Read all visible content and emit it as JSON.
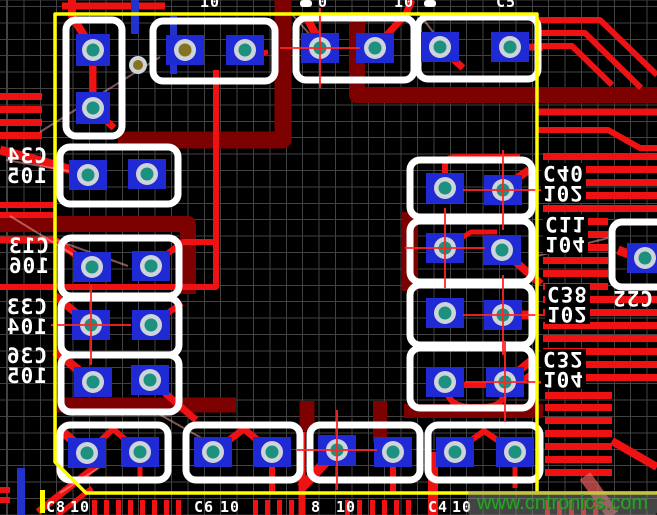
{
  "meta": {
    "width": 657,
    "height": 515,
    "description": "PCB layout close-up with decoupling capacitors around an IC courtyard"
  },
  "watermark": {
    "text": "www.cntronics.com",
    "color": "#2f9e2f",
    "bg": "rgba(135,135,135,0.5)",
    "x": 468,
    "y": 491,
    "w": 189,
    "h": 24
  },
  "labels": {
    "left": [
      {
        "ref": "C34",
        "val": "105",
        "x": 6,
        "y": 146
      },
      {
        "ref": "C13",
        "val": "106",
        "x": 8,
        "y": 236
      },
      {
        "ref": "C33",
        "val": "104",
        "x": 6,
        "y": 297
      },
      {
        "ref": "C36",
        "val": "105",
        "x": 6,
        "y": 346
      }
    ],
    "right": [
      {
        "ref": "C40",
        "val": "102",
        "x": 541,
        "y": 163
      },
      {
        "ref": "C11",
        "val": "104",
        "x": 543,
        "y": 214
      },
      {
        "ref": "C38",
        "val": "102",
        "x": 545,
        "y": 284
      },
      {
        "ref": "C32",
        "val": "104",
        "x": 541,
        "y": 349
      }
    ],
    "outside_right": {
      "text": "C22",
      "x": 612,
      "y": 288
    },
    "top_fragments": [
      {
        "t": "10",
        "x": 200
      },
      {
        "t": "0",
        "x": 318
      },
      {
        "t": "10",
        "x": 394
      },
      {
        "t": "C5",
        "x": 496
      }
    ],
    "bottom_fragments": [
      {
        "t": "C8",
        "x": 46
      },
      {
        "t": "10",
        "x": 70
      },
      {
        "t": "C6",
        "x": 194
      },
      {
        "t": "10",
        "x": 220
      },
      {
        "t": "8",
        "x": 311
      },
      {
        "t": "10",
        "x": 336
      },
      {
        "t": "C4",
        "x": 428
      },
      {
        "t": "10",
        "x": 452
      }
    ]
  },
  "colors": {
    "bg": "#000000",
    "grid": "#424242",
    "yellow": "#ffff00",
    "maroon": "#7d0101",
    "red": "#ee1212",
    "redsoft": "rgba(255,100,100,0.65)",
    "white": "#ffffff",
    "padblue": "#1f2ad4",
    "ring": "#cfd3da",
    "teal": "#1d9180",
    "olive": "#857321",
    "blue": "#2233cc",
    "rats": "rgba(255,170,170,0.5)",
    "cross": "#ff2626"
  },
  "pcb": {
    "pads": [
      {
        "x": 93,
        "y": 50,
        "w": 34,
        "h": 32
      },
      {
        "x": 93,
        "y": 108,
        "w": 34,
        "h": 32
      },
      {
        "x": 185,
        "y": 50,
        "v": "olive"
      },
      {
        "x": 245,
        "y": 50
      },
      {
        "x": 320,
        "y": 48
      },
      {
        "x": 375,
        "y": 48
      },
      {
        "x": 440,
        "y": 47
      },
      {
        "x": 510,
        "y": 47
      },
      {
        "x": 88,
        "y": 175
      },
      {
        "x": 147,
        "y": 174
      },
      {
        "x": 92,
        "y": 267
      },
      {
        "x": 151,
        "y": 266
      },
      {
        "x": 91,
        "y": 325
      },
      {
        "x": 151,
        "y": 325
      },
      {
        "x": 93,
        "y": 382
      },
      {
        "x": 150,
        "y": 380
      },
      {
        "x": 445,
        "y": 188
      },
      {
        "x": 503,
        "y": 190
      },
      {
        "x": 445,
        "y": 248
      },
      {
        "x": 502,
        "y": 250
      },
      {
        "x": 445,
        "y": 313
      },
      {
        "x": 503,
        "y": 315
      },
      {
        "x": 445,
        "y": 382
      },
      {
        "x": 505,
        "y": 382
      },
      {
        "x": 87,
        "y": 453
      },
      {
        "x": 140,
        "y": 452
      },
      {
        "x": 213,
        "y": 452
      },
      {
        "x": 272,
        "y": 452
      },
      {
        "x": 337,
        "y": 450
      },
      {
        "x": 393,
        "y": 452
      },
      {
        "x": 455,
        "y": 452
      },
      {
        "x": 515,
        "y": 452
      },
      {
        "x": 645,
        "y": 258,
        "w": 36,
        "h": 30
      }
    ],
    "small_vias": [
      {
        "x": 138,
        "y": 65
      }
    ],
    "outlines": [
      [
        66,
        20,
        56,
        116
      ],
      [
        153,
        21,
        122,
        60
      ],
      [
        296,
        18,
        118,
        62
      ],
      [
        418,
        17,
        120,
        62
      ],
      [
        60,
        147,
        118,
        57
      ],
      [
        61,
        238,
        118,
        58
      ],
      [
        61,
        298,
        118,
        57
      ],
      [
        61,
        355,
        118,
        57
      ],
      [
        410,
        160,
        122,
        57
      ],
      [
        410,
        221,
        122,
        61
      ],
      [
        410,
        285,
        122,
        60
      ],
      [
        410,
        348,
        122,
        60
      ],
      [
        60,
        425,
        108,
        55
      ],
      [
        186,
        425,
        114,
        55
      ],
      [
        310,
        425,
        110,
        55
      ],
      [
        428,
        425,
        112,
        55
      ],
      [
        612,
        222,
        62,
        65
      ]
    ],
    "white_stubs": [
      [
        300,
        0,
        12,
        7
      ],
      [
        424,
        0,
        12,
        7
      ]
    ],
    "maroon": [
      {
        "d": "M283,0 L283,140 L118,140",
        "w": 17
      },
      {
        "d": "M0,224 L188,224 L188,294",
        "w": 16
      },
      {
        "d": "M357,12 L357,95 L657,95",
        "w": 16
      },
      {
        "d": "M410,212 L410,291",
        "w": 16
      },
      {
        "d": "M56,405 L236,405",
        "w": 15
      },
      {
        "d": "M404,411 L543,411",
        "w": 14
      },
      {
        "d": "M307,401 L307,431",
        "w": 15
      },
      {
        "d": "M380,401 L380,442",
        "w": 14
      }
    ],
    "left_bars": [
      [
        0,
        93,
        42,
        7
      ],
      [
        0,
        106,
        42,
        7
      ],
      [
        0,
        119,
        42,
        7
      ],
      [
        0,
        132,
        42,
        7
      ],
      [
        0,
        202,
        55,
        6
      ],
      [
        0,
        212,
        55,
        6
      ],
      [
        0,
        487,
        10,
        6
      ],
      [
        0,
        497,
        10,
        6
      ]
    ],
    "right_bars": {
      "y_start": 153,
      "pitch": 13,
      "count": 18,
      "x": 543,
      "x2": 657,
      "h": 7,
      "short_from": 218,
      "short_to": 283,
      "short_x2": 608
    },
    "lower_right_bars": {
      "ys": [
        392,
        404,
        417,
        430,
        443,
        456,
        469
      ],
      "x": 545,
      "x2": 612,
      "h": 7
    },
    "red_paths": [
      {
        "d": "M0,150 L55,165 L88,175",
        "w": 9
      },
      {
        "d": "M93,50 L93,108",
        "w": 7
      },
      {
        "d": "M93,50 L72,16 L72,0",
        "w": 8
      },
      {
        "d": "M62,6 L165,6",
        "w": 7
      },
      {
        "d": "M93,108 L114,128",
        "w": 7
      },
      {
        "d": "M245,56 L268,52",
        "w": 5
      },
      {
        "d": "M216,70 L216,287 L0,287",
        "w": 6
      },
      {
        "d": "M0,240 L55,240 L92,267",
        "w": 7
      },
      {
        "d": "M151,266 L183,242 L216,242",
        "w": 6
      },
      {
        "d": "M55,296 L91,325",
        "w": 8
      },
      {
        "d": "M151,325 L182,303",
        "w": 6
      },
      {
        "d": "M55,351 L93,382",
        "w": 9
      },
      {
        "d": "M150,380 L196,420",
        "w": 7
      },
      {
        "d": "M308,20 L322,46",
        "w": 8
      },
      {
        "d": "M375,48 L406,14 L412,0",
        "w": 7
      },
      {
        "d": "M440,47 L463,68",
        "w": 7
      },
      {
        "d": "M510,47 L543,47",
        "w": 7
      },
      {
        "d": "M537,20 L600,20 L657,75",
        "w": 6
      },
      {
        "d": "M537,33 L585,33 L641,88",
        "w": 6
      },
      {
        "d": "M537,46 L572,46 L612,85",
        "w": 6
      },
      {
        "d": "M537,112 L657,112",
        "w": 7
      },
      {
        "d": "M537,130 L608,130 L640,148 L657,148",
        "w": 6
      },
      {
        "d": "M445,185 L445,166 Q445,157 457,157 L520,157",
        "w": 6
      },
      {
        "d": "M503,188 L529,170",
        "w": 8
      },
      {
        "d": "M502,250 L541,284",
        "w": 8
      },
      {
        "d": "M445,248 L471,232 L497,232",
        "w": 5
      },
      {
        "d": "M503,315 L536,315",
        "w": 9
      },
      {
        "d": "M505,382 L533,359",
        "w": 8
      },
      {
        "d": "M537,370 L516,385 L460,385",
        "w": 6
      },
      {
        "d": "M445,384 Q447,407 470,407 L482,407 Q505,407 505,390",
        "w": 6
      },
      {
        "d": "M618,250 L639,258",
        "w": 9
      },
      {
        "d": "M58,428 L87,453",
        "w": 9
      },
      {
        "d": "M87,453 L113,429 L140,452",
        "w": 6
      },
      {
        "d": "M140,452 L140,480",
        "w": 5
      },
      {
        "d": "M213,452 L244,429 L272,452",
        "w": 7
      },
      {
        "d": "M272,452 L272,492",
        "w": 6
      },
      {
        "d": "M302,432 L302,515",
        "w": 7
      },
      {
        "d": "M337,450 L301,488",
        "w": 10
      },
      {
        "d": "M393,452 L393,492",
        "w": 6
      },
      {
        "d": "M433,452 L433,515",
        "w": 10
      },
      {
        "d": "M455,452 L484,431 L515,452",
        "w": 6
      },
      {
        "d": "M515,452 L515,488",
        "w": 5
      },
      {
        "d": "M38,512 L96,466",
        "w": 7
      },
      {
        "d": "M58,515 L92,488",
        "w": 5
      },
      {
        "d": "M612,441 L657,467",
        "w": 8
      },
      {
        "d": "M585,476 L613,515",
        "w": 13,
        "c": "redsoft"
      }
    ],
    "bottom_stubs": {
      "y": 500,
      "w": 5,
      "h": 15,
      "xs": [
        92,
        104,
        116,
        128,
        140,
        152,
        164,
        176,
        253,
        265,
        277,
        289,
        345,
        357,
        370,
        382,
        394,
        406,
        545,
        557,
        569,
        581,
        593
      ]
    },
    "blue_rects": [
      [
        131,
        0,
        8,
        34
      ],
      [
        170,
        16,
        7,
        58
      ],
      [
        17,
        468,
        8,
        47
      ]
    ],
    "ratsnest": [
      "M40,132 L160,57",
      "M6,160 L86,174",
      "M10,216 L90,265",
      "M56,240 L128,266",
      "M537,256 L608,238",
      "M150,409 L228,453",
      "M290,12 L320,46",
      "M418,12 L442,44",
      "M100,467 L60,493"
    ],
    "crosshairs": [
      [
        320,
        48
      ],
      [
        91,
        325
      ],
      [
        445,
        248
      ],
      [
        503,
        190
      ],
      [
        503,
        315
      ],
      [
        505,
        382
      ],
      [
        337,
        450
      ]
    ],
    "courtyard": {
      "main": "M55,14 L537,14 L537,493 L86,493 L55,462 Z",
      "extension": "M537,493 L657,493",
      "dash": [
        40,
        490,
        5,
        23
      ],
      "stroke": 3.5
    }
  }
}
